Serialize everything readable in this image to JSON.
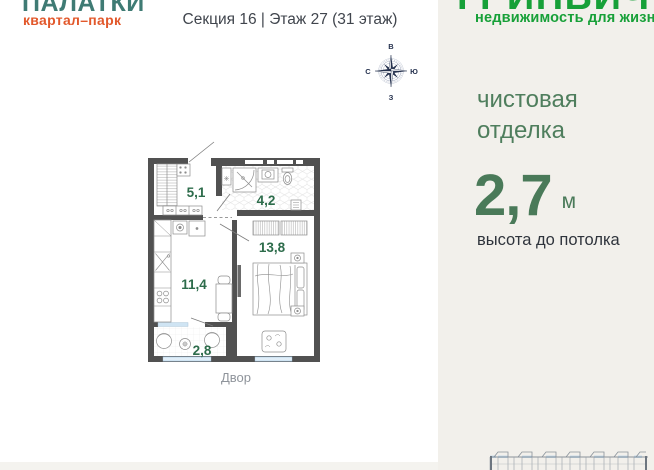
{
  "brand_left": {
    "title": "ПАЛАТКИ",
    "subtitle": "квартал–парк"
  },
  "header": {
    "section_floor": "Секция 16 | Этаж 27 (31 этаж)"
  },
  "compass": {
    "top": "В",
    "right": "Ю",
    "bottom": "З",
    "left": "С"
  },
  "floor_plan": {
    "rooms": [
      {
        "name": "hallway",
        "area": "5,1"
      },
      {
        "name": "bathroom",
        "area": "4,2"
      },
      {
        "name": "living-room",
        "area": "13,8"
      },
      {
        "name": "kitchen",
        "area": "11,4"
      },
      {
        "name": "balcony",
        "area": "2,8"
      }
    ],
    "yard_label": "Двор"
  },
  "brand_right": {
    "title": "ГРИНВИЧ",
    "subtitle": "недвижимость для жизни"
  },
  "highlights": {
    "finish_line1": "чистовая",
    "finish_line2": "отделка",
    "ceiling_value": "2,7",
    "ceiling_unit": "м",
    "ceiling_caption": "высота до потолка"
  },
  "colors": {
    "brand_teal": "#3f7b74",
    "brand_orange": "#e2582b",
    "brand_green": "#17a038",
    "muted_green": "#4f7e5d",
    "room_label_green": "#2d6c4b",
    "wall_gray": "#515151",
    "window_blue": "#cfe4f3",
    "panel_beige": "#f2f0eb",
    "compass_navy": "#26324f"
  }
}
